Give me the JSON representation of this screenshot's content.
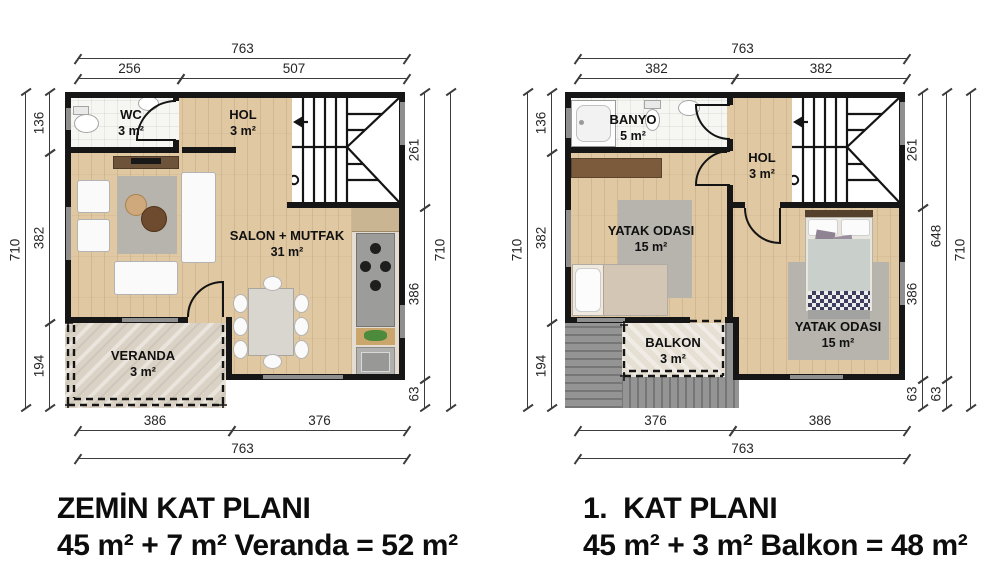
{
  "colors": {
    "wall": "#161616",
    "wood_floor": "#e0c8a2",
    "bathroom_tile": "#f6f6f3",
    "veranda_stone": "#dad2c5",
    "balcony_deck": "#8b8b8b",
    "rug": "#b7b4ae",
    "dimension_line": "#3c3c3c",
    "text": "#0d0d0d"
  },
  "ground": {
    "title": "ZEMİN KAT PLANI",
    "subtitle": "45 m² + 7 m² Veranda = 52 m²",
    "rooms": {
      "wc": {
        "name": "WC",
        "area": "3 m²"
      },
      "hol": {
        "name": "HOL",
        "area": "3 m²"
      },
      "salon": {
        "name": "SALON + MUTFAK",
        "area": "31 m²"
      },
      "veranda": {
        "name": "VERANDA",
        "area": "3 m²"
      }
    },
    "dims": {
      "total_w": "763",
      "top_left": "256",
      "top_right": "507",
      "bottom_left": "386",
      "bottom_right": "376",
      "total_h": "710",
      "left_top": "136",
      "left_mid": "382",
      "left_bottom": "194",
      "right_top": "261",
      "right_mid": "386",
      "right_bottom": "63"
    }
  },
  "first": {
    "title": "1.  KAT PLANI",
    "subtitle": "45 m² + 3 m² Balkon = 48 m²",
    "rooms": {
      "banyo": {
        "name": "BANYO",
        "area": "5 m²"
      },
      "hol": {
        "name": "HOL",
        "area": "3 m²"
      },
      "bedroom_left": {
        "name": "YATAK ODASI",
        "area": "15 m²"
      },
      "bedroom_right": {
        "name": "YATAK ODASI",
        "area": "15 m²"
      },
      "balkon": {
        "name": "BALKON",
        "area": "3 m²"
      }
    },
    "dims": {
      "total_w": "763",
      "top_left": "382",
      "top_right": "382",
      "bottom_left": "376",
      "bottom_right": "386",
      "total_h": "710",
      "left_top": "136",
      "left_mid": "382",
      "left_bottom": "194",
      "right_top": "261",
      "right_mid": "386",
      "right_bottom": "63",
      "right_span": "648",
      "right_span_bottom": "63"
    }
  }
}
